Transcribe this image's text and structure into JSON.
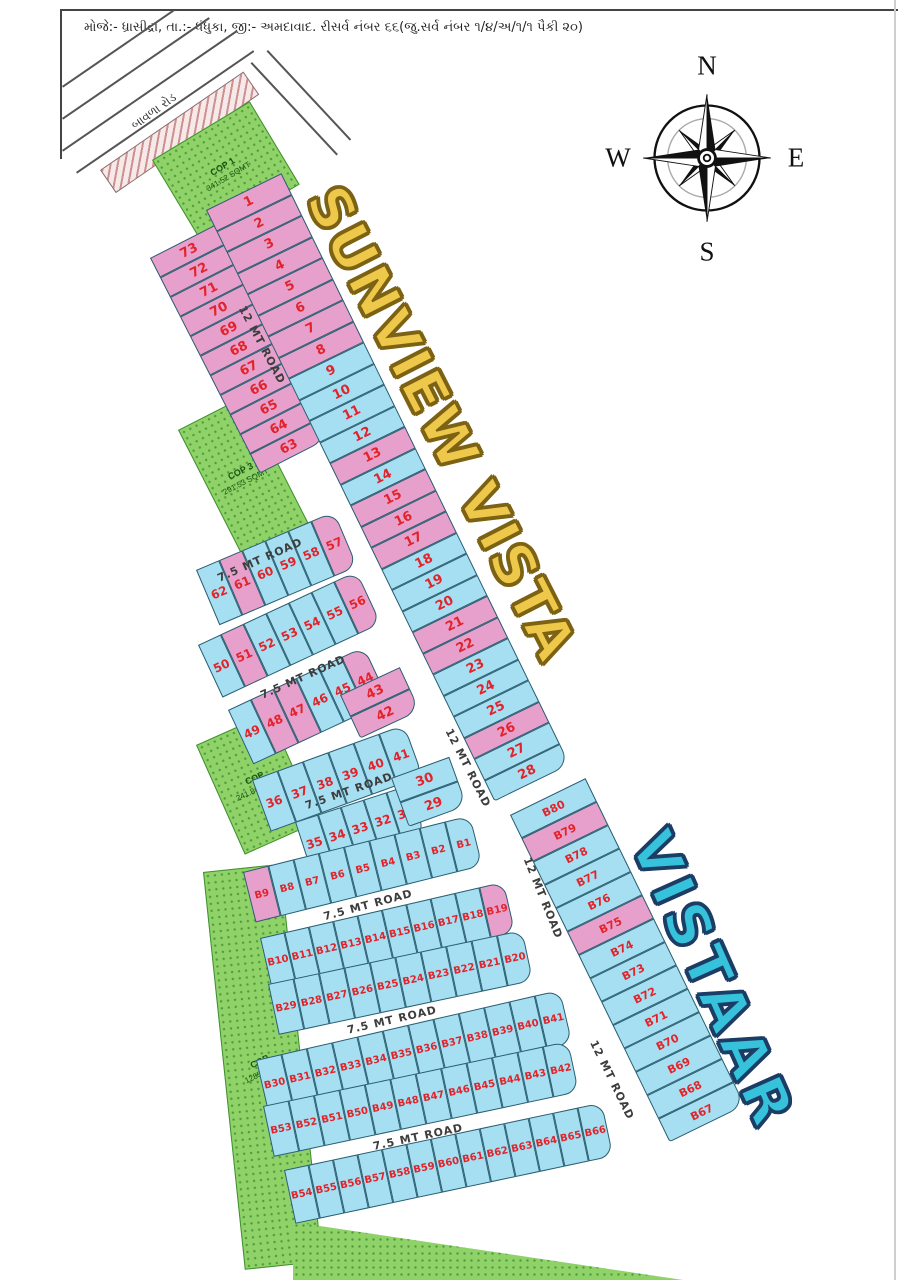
{
  "header": {
    "survey_text": "મોજે:- ધ્રાસીદ્રા, તા.:- ધંધુકા, જી:- અમદાવાદ.   રીસર્વ નંબર ૬૬(જુ.સર્વ નંબર ૧/૪/અ/૧/૧ પૈકી ૨૦)"
  },
  "compass": {
    "n": "N",
    "e": "E",
    "s": "S",
    "w": "W"
  },
  "titles": {
    "primary": {
      "text": "SUNVIEW VISTA",
      "color": "#eec84b",
      "outline": "#7c6212"
    },
    "secondary": {
      "text": "VISTAAR",
      "color": "#35c2da",
      "outline": "#1b3d66"
    }
  },
  "legend_colors": {
    "plot_pink": "#e7a0cc",
    "plot_blue": "#a6dff2",
    "open_space_green": "#8ed268",
    "number_red": "#e2232a",
    "plot_border": "#2a5e70"
  },
  "top_left_road_name": "બાવળા રોડ",
  "map": {
    "roads": [
      {
        "label": "12 MT ROAD",
        "x": 262,
        "y": 345,
        "rot": 62
      },
      {
        "label": "7.5 MT ROAD",
        "x": 260,
        "y": 560,
        "rot": -24
      },
      {
        "label": "7.5 MT ROAD",
        "x": 303,
        "y": 677,
        "rot": -24
      },
      {
        "label": "7.5 MT ROAD",
        "x": 349,
        "y": 791,
        "rot": -19
      },
      {
        "label": "7.5 MT ROAD",
        "x": 368,
        "y": 905,
        "rot": -15
      },
      {
        "label": "7.5 MT ROAD",
        "x": 392,
        "y": 1020,
        "rot": -13
      },
      {
        "label": "7.5 MT ROAD",
        "x": 418,
        "y": 1137,
        "rot": -12
      },
      {
        "label": "12 MT ROAD",
        "x": 468,
        "y": 768,
        "rot": 63
      },
      {
        "label": "12 MT ROAD",
        "x": 543,
        "y": 898,
        "rot": 68
      },
      {
        "label": "12 MT ROAD",
        "x": 612,
        "y": 1080,
        "rot": 64
      }
    ],
    "cop_areas": [
      {
        "name": "cop-1",
        "x": 152,
        "y": 160,
        "w": 112,
        "h": 95,
        "rot": -31,
        "lines": [
          "COP 1",
          "341.52 SQMT"
        ]
      },
      {
        "name": "cop-3",
        "x": 178,
        "y": 430,
        "w": 72,
        "h": 140,
        "rot": -27,
        "lines": [
          "COP 3",
          "291.53 SQMT"
        ]
      },
      {
        "name": "cop-2",
        "x": 196,
        "y": 745,
        "w": 78,
        "h": 118,
        "rot": -24,
        "lines": [
          "COP",
          "241.86 SQMT"
        ]
      },
      {
        "name": "cop-4",
        "x": 203,
        "y": 872,
        "w": 76,
        "h": 398,
        "rot": -6,
        "lines": [
          "COP",
          "1285 SQMT"
        ],
        "label_rot": -20
      },
      {
        "name": "cop-bottom-wedge",
        "x": 293,
        "y": 1222,
        "w": 390,
        "h": 58,
        "rot": 0,
        "lines": [],
        "wedge": true
      }
    ],
    "lines": [
      {
        "x": 62,
        "y": 9,
        "len": 836,
        "rot": 0,
        "w": 1.5,
        "color": "#444"
      },
      {
        "x": 62,
        "y": 9,
        "len": 150,
        "rot": 90,
        "w": 1.5,
        "color": "#444"
      },
      {
        "x": 896,
        "y": 0,
        "len": 1280,
        "rot": 90,
        "w": 2,
        "color": "#cfcfcf"
      },
      {
        "x": 62,
        "y": 150,
        "len": 212,
        "rot": -34.5,
        "w": 1.5,
        "color": "#555"
      },
      {
        "x": 76,
        "y": 172,
        "len": 215,
        "rot": -34.5,
        "w": 1.5,
        "color": "#555"
      },
      {
        "x": 62,
        "y": 118,
        "len": 178,
        "rot": -34.5,
        "w": 1.5,
        "color": "#555"
      },
      {
        "x": 62,
        "y": 86,
        "len": 135,
        "rot": -34.5,
        "w": 1.5,
        "color": "#555"
      },
      {
        "x": 252,
        "y": 62,
        "len": 126,
        "rot": 47,
        "w": 1.5,
        "color": "#555"
      },
      {
        "x": 268,
        "y": 50,
        "len": 122,
        "rot": 47,
        "w": 1.5,
        "color": "#555"
      }
    ],
    "hatch_road": {
      "x": 100,
      "y": 170,
      "w": 172,
      "h": 26,
      "rot": -34.5
    },
    "strips": [
      {
        "name": "plots-73-63",
        "dir": "col",
        "x": 150,
        "y": 258,
        "rot": -27,
        "w": 76,
        "ch": 22,
        "fs": 13,
        "plots": [
          [
            "73",
            "p"
          ],
          [
            "72",
            "p"
          ],
          [
            "71",
            "p"
          ],
          [
            "70",
            "p"
          ],
          [
            "69",
            "p"
          ],
          [
            "68",
            "p"
          ],
          [
            "67",
            "p"
          ],
          [
            "66",
            "p"
          ],
          [
            "65",
            "p"
          ],
          [
            "64",
            "p"
          ],
          [
            "63",
            "p"
          ]
        ]
      },
      {
        "name": "plots-1-28",
        "dir": "col",
        "x": 206,
        "y": 210,
        "rot": -26,
        "w": 84,
        "ch": 23.5,
        "fs": 13,
        "plots": [
          [
            "1",
            "p"
          ],
          [
            "2",
            "p"
          ],
          [
            "3",
            "p"
          ],
          [
            "4",
            "p"
          ],
          [
            "5",
            "p"
          ],
          [
            "6",
            "p"
          ],
          [
            "7",
            "p"
          ],
          [
            "8",
            "p"
          ],
          [
            "9",
            "b"
          ],
          [
            "10",
            "b"
          ],
          [
            "11",
            "b"
          ],
          [
            "12",
            "b"
          ],
          [
            "13",
            "p"
          ],
          [
            "14",
            "b"
          ],
          [
            "15",
            "p"
          ],
          [
            "16",
            "p"
          ],
          [
            "17",
            "p"
          ],
          [
            "18",
            "b"
          ],
          [
            "19",
            "b"
          ],
          [
            "20",
            "b"
          ],
          [
            "21",
            "p"
          ],
          [
            "22",
            "p"
          ],
          [
            "23",
            "b"
          ],
          [
            "24",
            "b"
          ],
          [
            "25",
            "b"
          ],
          [
            "26",
            "p"
          ],
          [
            "27",
            "b"
          ],
          [
            "28",
            "b"
          ]
        ]
      },
      {
        "name": "plots-B80-B67",
        "dir": "col",
        "x": 510,
        "y": 815,
        "rot": -26,
        "w": 84,
        "ch": 26,
        "fs": 11,
        "plots": [
          [
            "B80",
            "b"
          ],
          [
            "B79",
            "p"
          ],
          [
            "B78",
            "b"
          ],
          [
            "B77",
            "b"
          ],
          [
            "B76",
            "b"
          ],
          [
            "B75",
            "p"
          ],
          [
            "B74",
            "b"
          ],
          [
            "B73",
            "b"
          ],
          [
            "B72",
            "b"
          ],
          [
            "B71",
            "b"
          ],
          [
            "B70",
            "b"
          ],
          [
            "B69",
            "b"
          ],
          [
            "B68",
            "b"
          ],
          [
            "B67",
            "b"
          ]
        ]
      },
      {
        "name": "plots-62-57",
        "dir": "row",
        "x": 196,
        "y": 570,
        "rot": -23,
        "cw": 25,
        "h": 60,
        "fs": 12,
        "plots": [
          [
            "62",
            "b"
          ],
          [
            "61",
            "p"
          ],
          [
            "60",
            "b"
          ],
          [
            "59",
            "b"
          ],
          [
            "58",
            "b"
          ],
          [
            "57",
            "p"
          ]
        ]
      },
      {
        "name": "plots-50-56",
        "dir": "row",
        "x": 198,
        "y": 645,
        "rot": -25,
        "cw": 25,
        "h": 58,
        "fs": 12,
        "plots": [
          [
            "50",
            "b"
          ],
          [
            "51",
            "p"
          ],
          [
            "52",
            "b"
          ],
          [
            "53",
            "b"
          ],
          [
            "54",
            "b"
          ],
          [
            "55",
            "b"
          ],
          [
            "56",
            "p"
          ]
        ]
      },
      {
        "name": "plots-49-44",
        "dir": "row",
        "x": 228,
        "y": 710,
        "rot": -25,
        "cw": 25,
        "h": 60,
        "fs": 12,
        "plots": [
          [
            "49",
            "b"
          ],
          [
            "48",
            "p"
          ],
          [
            "47",
            "p"
          ],
          [
            "46",
            "b"
          ],
          [
            "45",
            "b"
          ],
          [
            "44",
            "p"
          ]
        ]
      },
      {
        "name": "plots-43-42",
        "dir": "col",
        "x": 340,
        "y": 695,
        "rot": -25,
        "w": 66,
        "ch": 24,
        "fs": 13,
        "plots": [
          [
            "43",
            "p"
          ],
          [
            "42",
            "p"
          ]
        ]
      },
      {
        "name": "plots-36-41",
        "dir": "row",
        "x": 252,
        "y": 780,
        "rot": -20,
        "cw": 27,
        "h": 55,
        "fs": 12,
        "plots": [
          [
            "36",
            "b"
          ],
          [
            "37",
            "b"
          ],
          [
            "38",
            "b"
          ],
          [
            "39",
            "b"
          ],
          [
            "40",
            "b"
          ],
          [
            "41",
            "b"
          ]
        ]
      },
      {
        "name": "plots-35-31",
        "dir": "row",
        "x": 295,
        "y": 822,
        "rot": -18,
        "cw": 24,
        "h": 52,
        "fs": 12,
        "plots": [
          [
            "35",
            "b"
          ],
          [
            "34",
            "b"
          ],
          [
            "33",
            "b"
          ],
          [
            "32",
            "b"
          ],
          [
            "31",
            "b"
          ]
        ]
      },
      {
        "name": "plots-30-29",
        "dir": "col",
        "x": 391,
        "y": 778,
        "rot": -20,
        "w": 62,
        "ch": 26,
        "fs": 13,
        "plots": [
          [
            "30",
            "b"
          ],
          [
            "29",
            "b"
          ]
        ]
      },
      {
        "name": "plots-B9-B1",
        "dir": "row",
        "x": 243,
        "y": 872,
        "rot": -14,
        "cw": 26,
        "h": 52,
        "fs": 10,
        "plots": [
          [
            "B9",
            "p"
          ],
          [
            "B8",
            "b"
          ],
          [
            "B7",
            "b"
          ],
          [
            "B6",
            "b"
          ],
          [
            "B5",
            "b"
          ],
          [
            "B4",
            "b"
          ],
          [
            "B3",
            "b"
          ],
          [
            "B2",
            "b"
          ],
          [
            "B1",
            "b"
          ]
        ]
      },
      {
        "name": "plots-B10-B19",
        "dir": "row",
        "x": 260,
        "y": 938,
        "rot": -13,
        "cw": 25,
        "h": 52,
        "fs": 10,
        "plots": [
          [
            "B10",
            "b"
          ],
          [
            "B11",
            "b"
          ],
          [
            "B12",
            "b"
          ],
          [
            "B13",
            "b"
          ],
          [
            "B14",
            "b"
          ],
          [
            "B15",
            "b"
          ],
          [
            "B16",
            "b"
          ],
          [
            "B17",
            "b"
          ],
          [
            "B18",
            "b"
          ],
          [
            "B19",
            "p"
          ]
        ]
      },
      {
        "name": "plots-B29-B20",
        "dir": "row",
        "x": 268,
        "y": 984,
        "rot": -12,
        "cw": 26,
        "h": 52,
        "fs": 10,
        "plots": [
          [
            "B29",
            "b"
          ],
          [
            "B28",
            "b"
          ],
          [
            "B27",
            "b"
          ],
          [
            "B26",
            "b"
          ],
          [
            "B25",
            "b"
          ],
          [
            "B24",
            "b"
          ],
          [
            "B23",
            "b"
          ],
          [
            "B22",
            "b"
          ],
          [
            "B21",
            "b"
          ],
          [
            "B20",
            "b"
          ]
        ]
      },
      {
        "name": "plots-B30-B41",
        "dir": "row",
        "x": 256,
        "y": 1060,
        "rot": -13,
        "cw": 26,
        "h": 55,
        "fs": 10,
        "plots": [
          [
            "B30",
            "b"
          ],
          [
            "B31",
            "b"
          ],
          [
            "B32",
            "b"
          ],
          [
            "B33",
            "b"
          ],
          [
            "B34",
            "b"
          ],
          [
            "B35",
            "b"
          ],
          [
            "B36",
            "b"
          ],
          [
            "B37",
            "b"
          ],
          [
            "B38",
            "b"
          ],
          [
            "B39",
            "b"
          ],
          [
            "B40",
            "b"
          ],
          [
            "B41",
            "b"
          ]
        ]
      },
      {
        "name": "plots-B53-B42",
        "dir": "row",
        "x": 263,
        "y": 1106,
        "rot": -12,
        "cw": 26,
        "h": 52,
        "fs": 10,
        "plots": [
          [
            "B53",
            "b"
          ],
          [
            "B52",
            "b"
          ],
          [
            "B51",
            "b"
          ],
          [
            "B50",
            "b"
          ],
          [
            "B49",
            "b"
          ],
          [
            "B48",
            "b"
          ],
          [
            "B47",
            "b"
          ],
          [
            "B46",
            "b"
          ],
          [
            "B45",
            "b"
          ],
          [
            "B44",
            "b"
          ],
          [
            "B43",
            "b"
          ],
          [
            "B42",
            "b"
          ]
        ]
      },
      {
        "name": "plots-B54-B66",
        "dir": "row",
        "x": 284,
        "y": 1170,
        "rot": -12,
        "cw": 25,
        "h": 55,
        "fs": 10,
        "plots": [
          [
            "B54",
            "b"
          ],
          [
            "B55",
            "b"
          ],
          [
            "B56",
            "b"
          ],
          [
            "B57",
            "b"
          ],
          [
            "B58",
            "b"
          ],
          [
            "B59",
            "b"
          ],
          [
            "B60",
            "b"
          ],
          [
            "B61",
            "b"
          ],
          [
            "B62",
            "b"
          ],
          [
            "B63",
            "b"
          ],
          [
            "B64",
            "b"
          ],
          [
            "B65",
            "b"
          ],
          [
            "B66",
            "b"
          ]
        ]
      }
    ]
  }
}
